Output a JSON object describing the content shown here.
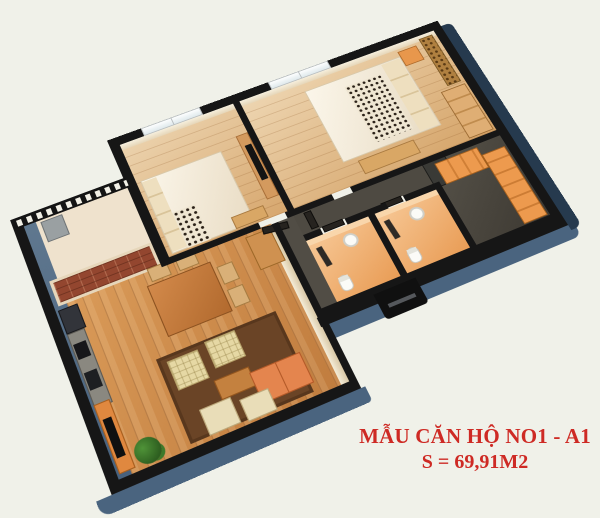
{
  "page": {
    "background_color": "#f0f1e9"
  },
  "caption": {
    "line1": "MẪU CĂN HỘ NO1 - A1",
    "line2": "S = 69,91M2",
    "text_color": "#ce2a24"
  },
  "floorplan": {
    "view": "3d-isometric-apartment-render",
    "palette": {
      "wall_top": "#161616",
      "wall_side_blue": "#4a647f",
      "wall_side_dark": "#263a4e",
      "wood_floor_living": "#c8884a",
      "wood_floor_bedroom": "#ddb07a",
      "bathroom_tile": "#eda25c",
      "corridor_floor": "#4e4a42",
      "balcony_door": "#93462f",
      "accent_cabinet_orange": "#e0883f",
      "sofa_orange": "#e4854e",
      "armchair_cream": "#e6d8a4",
      "rug_brown": "#6a4426"
    },
    "rooms": [
      {
        "name": "balcony",
        "visible_items": [
          "striped-railing",
          "sliding-glass-door",
          "storage-cabinet"
        ]
      },
      {
        "name": "kitchen-dining",
        "visible_items": [
          "fridge",
          "counter-with-stove-and-sink",
          "dining-table",
          "four-chairs",
          "sideboard"
        ]
      },
      {
        "name": "living-room",
        "visible_items": [
          "brown-rug",
          "two-cream-armchairs",
          "orange-sofa",
          "coffee-table",
          "two-loungers",
          "tv-cabinet-with-tv",
          "plant"
        ]
      },
      {
        "name": "bedroom-1",
        "visible_items": [
          "double-bed",
          "leopard-throw",
          "window",
          "tv-stand-with-tv",
          "dresser"
        ]
      },
      {
        "name": "bedroom-2",
        "visible_items": [
          "double-bed",
          "leopard-throw",
          "window",
          "headboard-art-panel",
          "nightstand",
          "wardrobe",
          "bench"
        ]
      },
      {
        "name": "bathroom-1",
        "visible_items": [
          "sink",
          "toilet",
          "mirror",
          "door"
        ]
      },
      {
        "name": "bathroom-2",
        "visible_items": [
          "sink",
          "toilet",
          "mirror",
          "door"
        ]
      },
      {
        "name": "corridor",
        "visible_items": [
          "bedroom-doors",
          "dark-floor"
        ]
      },
      {
        "name": "entry-hall",
        "visible_items": [
          "shoe-cabinet-drawers",
          "console-counter",
          "side-table",
          "entrance-step"
        ]
      }
    ]
  }
}
